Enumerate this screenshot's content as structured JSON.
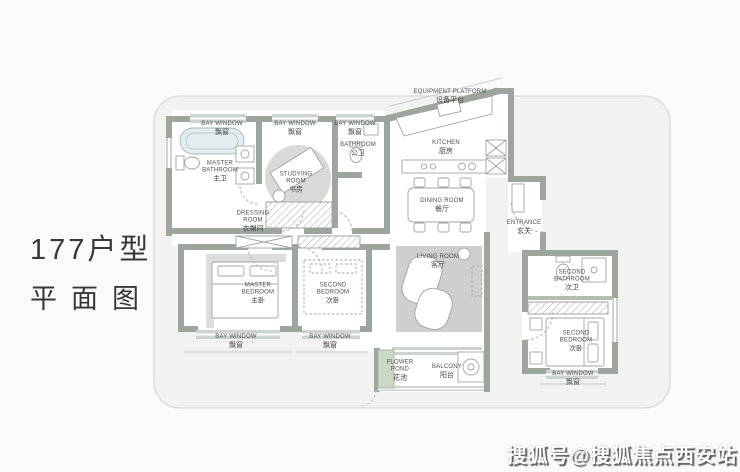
{
  "title": {
    "line1": "177户型",
    "line2": "平面图"
  },
  "watermark": "搜狐号@搜狐焦点西安站",
  "rooms": {
    "bay_window": {
      "en": "BAY WINDOW",
      "zh": "飘窗"
    },
    "master_bathroom": {
      "en": "MASTER BATHROOM",
      "zh": "主卫"
    },
    "studying_room": {
      "en": "STUDYING ROOM",
      "zh": "书房"
    },
    "bathroom": {
      "en": "BATHROOM",
      "zh": "公卫"
    },
    "dressing_room": {
      "en": "DRESSING ROOM",
      "zh": "衣帽间"
    },
    "equipment_platform": {
      "en": "EQUIPMENT PLATFORM",
      "zh": "设备平台"
    },
    "kitchen": {
      "en": "KITCHEN",
      "zh": "厨房"
    },
    "dining_room": {
      "en": "DINING ROOM",
      "zh": "餐厅"
    },
    "entrance": {
      "en": "ENTRANCE",
      "zh": "玄关"
    },
    "living_room": {
      "en": "LIVING ROOM",
      "zh": "客厅"
    },
    "master_bedroom": {
      "en": "MASTER BEDROOM",
      "zh": "主卧"
    },
    "second_bedroom": {
      "en": "SECOND BEDROOM",
      "zh": "次卧"
    },
    "second_bathroom": {
      "en": "SECOND BATHROOM",
      "zh": "次卫"
    },
    "flower_pond": {
      "en": "FLOWER POND",
      "zh": "花池"
    },
    "balcony": {
      "en": "BALCONY",
      "zh": "阳台"
    }
  },
  "colors": {
    "wall": "#9ca69e",
    "window_band": "#cdd4cf",
    "flower_pond": "#ccd8c6",
    "rug": "#cfcfcd",
    "shadow_outline": "#dadad6",
    "watermark_text": "#ffffff"
  }
}
